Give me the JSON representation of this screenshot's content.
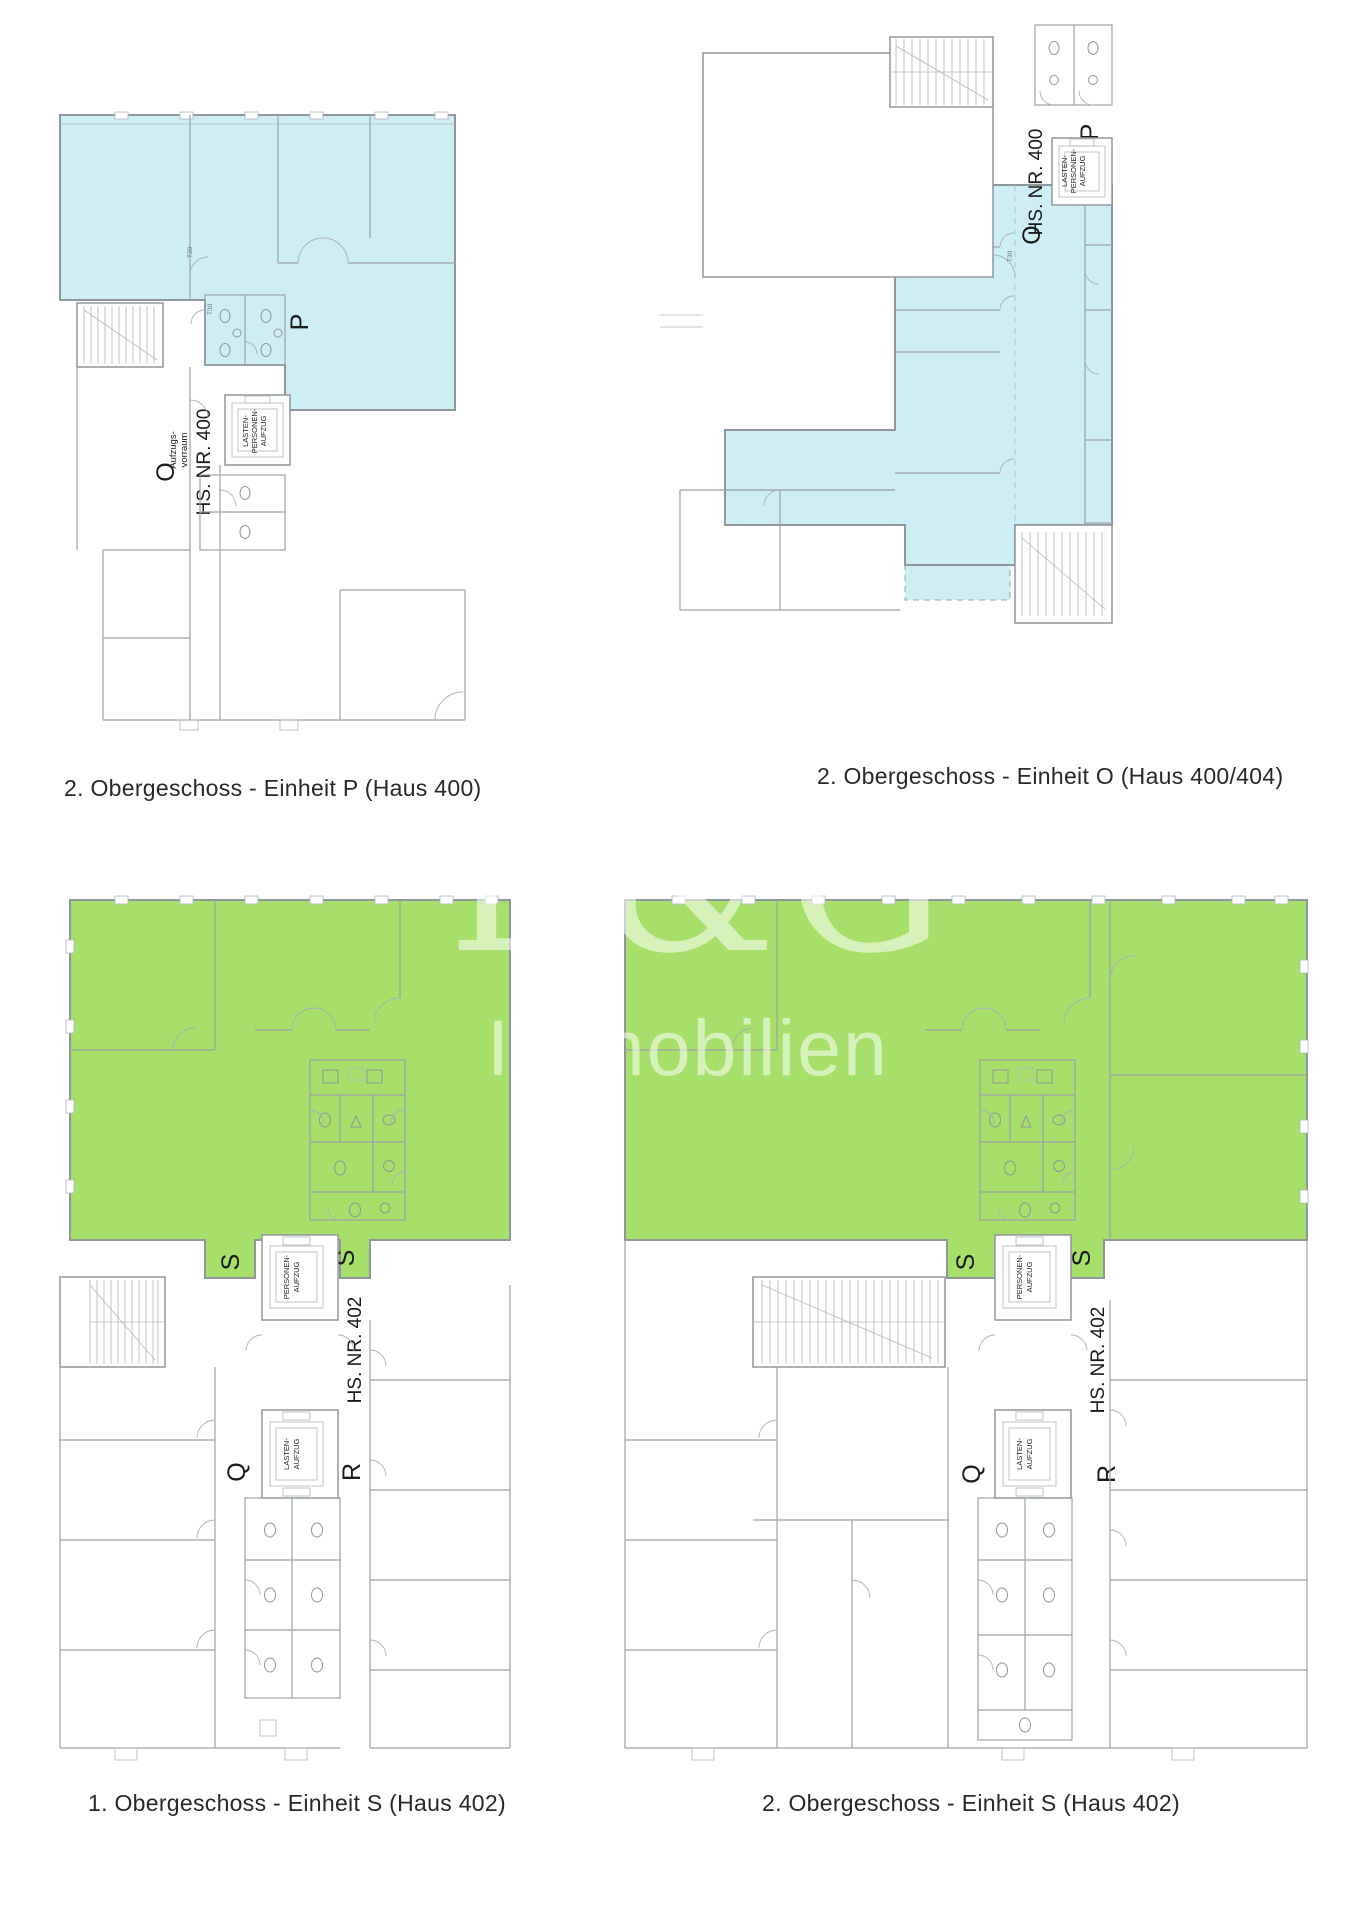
{
  "document": {
    "type": "floor-plan-expose-page",
    "background": "#ffffff"
  },
  "colors": {
    "highlight_blue": "#cdeef4",
    "highlight_green": "#a6df69",
    "wall_line": "#8f979c",
    "caption_text": "#26282a",
    "watermark": "rgba(255,255,255,0.55)"
  },
  "watermark": {
    "brand": "E&G",
    "subtitle": "Immobilien"
  },
  "plans": {
    "p": {
      "caption": "2. Obergeschoss - Einheit P (Haus 400)",
      "unit_label": "P",
      "neighbor_label": "O",
      "house_label": "HS. NR. 400",
      "anteroom_label_line1": "Aufzugs-",
      "anteroom_label_line2": "vorraum",
      "elevator_label_line1": "LASTEN-",
      "elevator_label_line2": "PERSONEN-",
      "elevator_label_line3": "AUFZUG",
      "door_label": "T30"
    },
    "o": {
      "caption": "2. Obergeschoss - Einheit O (Haus 400/404)",
      "unit_label": "O",
      "neighbor_label": "P",
      "house_label": "HS. NR. 400",
      "elevator_label_line1": "LASTEN-",
      "elevator_label_line2": "PERSONEN-",
      "elevator_label_line3": "AUFZUG",
      "door_label": "T30"
    },
    "s1": {
      "caption": "1. Obergeschoss - Einheit S (Haus 402)",
      "unit_label_left": "S",
      "unit_label_right": "S",
      "label_q": "Q",
      "label_r": "R",
      "house_label": "HS. NR. 402",
      "passenger_elevator_line1": "PERSONEN-",
      "passenger_elevator_line2": "AUFZUG",
      "freight_elevator_line1": "LASTEN-",
      "freight_elevator_line2": "AUFZUG"
    },
    "s2": {
      "caption": "2. Obergeschoss - Einheit S (Haus 402)",
      "unit_label_left": "S",
      "unit_label_right": "S",
      "label_q": "Q",
      "label_r": "R",
      "house_label": "HS. NR. 402",
      "passenger_elevator_line1": "PERSONEN-",
      "passenger_elevator_line2": "AUFZUG",
      "freight_elevator_line1": "LASTEN-",
      "freight_elevator_line2": "AUFZUG"
    }
  }
}
